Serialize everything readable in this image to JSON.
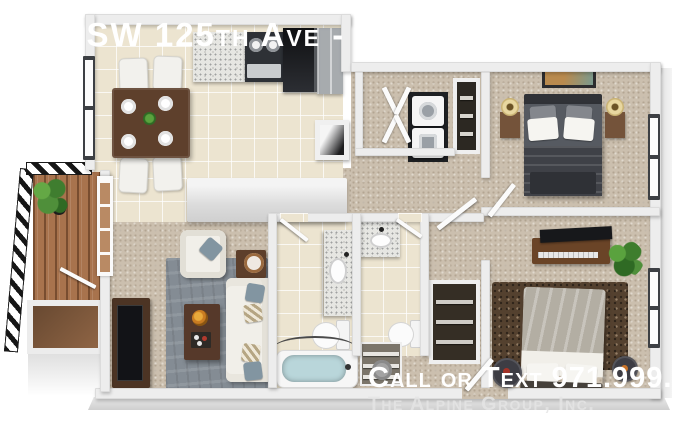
{
  "overlay": {
    "address": "0 SW 125th Ave - 107B",
    "phone_cta": "Call or Text 971.999.3214",
    "company": "The Alpine Group, Inc."
  },
  "palette": {
    "wall": "#ededed",
    "tile": "#ece4d0",
    "carpet": "#cbbfae",
    "granite": "#e6e6e2",
    "deck": "#a8734d",
    "rugLiving": "#848c94",
    "rugBedroom2": "#54412f",
    "sofaWhite": "#f1efe9",
    "woodDark": "#56392a",
    "bedMaster": "#565a61",
    "bedMasterFoot": "#2f3136",
    "bedGuest": "#b3aea3",
    "applianceDark": "#1e2023",
    "steel": "#a7abae",
    "tubBlue": "#b9d6da",
    "plantGreen": "#4f8f3a",
    "lampYellow": "#e8d7a0",
    "textWhite": "#ffffff",
    "textGray": "#e4e4e4"
  }
}
